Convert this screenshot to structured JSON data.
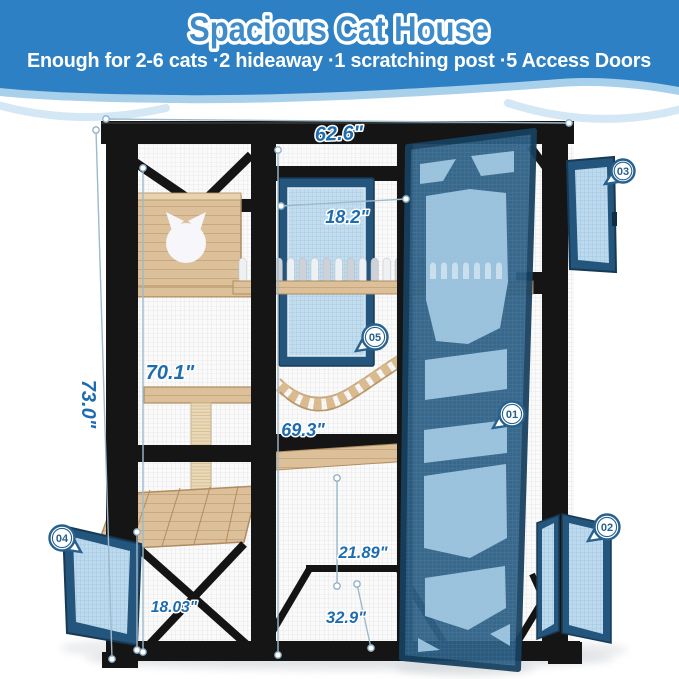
{
  "header": {
    "title": "Spacious Cat House",
    "subtitle": "Enough for 2-6 cats ·2 hideaway ·1 scratching post ·5 Access Doors"
  },
  "dimensions": {
    "top_width": "62.6\"",
    "overall_height": "73.0\"",
    "left_inner_height": "70.1\"",
    "window_width": "18.2\"",
    "mid_inner_height": "69.3\"",
    "lower_section_height": "21.89\"",
    "platform_to_ground": "18.03\"",
    "depth": "32.9\""
  },
  "badges": [
    {
      "label": "01"
    },
    {
      "label": "02"
    },
    {
      "label": "03"
    },
    {
      "label": "04"
    },
    {
      "label": "05"
    }
  ],
  "colors": {
    "header_blue": "#2e80c4",
    "wave_light": "#a9d0ea",
    "dimension_text": "#1e6cb0",
    "badge_ring": "#27618e",
    "door_frame": "#24557c",
    "door_mesh_light": "#a8cfe9",
    "frame_black": "#151515",
    "wood": "#dcc09a"
  }
}
